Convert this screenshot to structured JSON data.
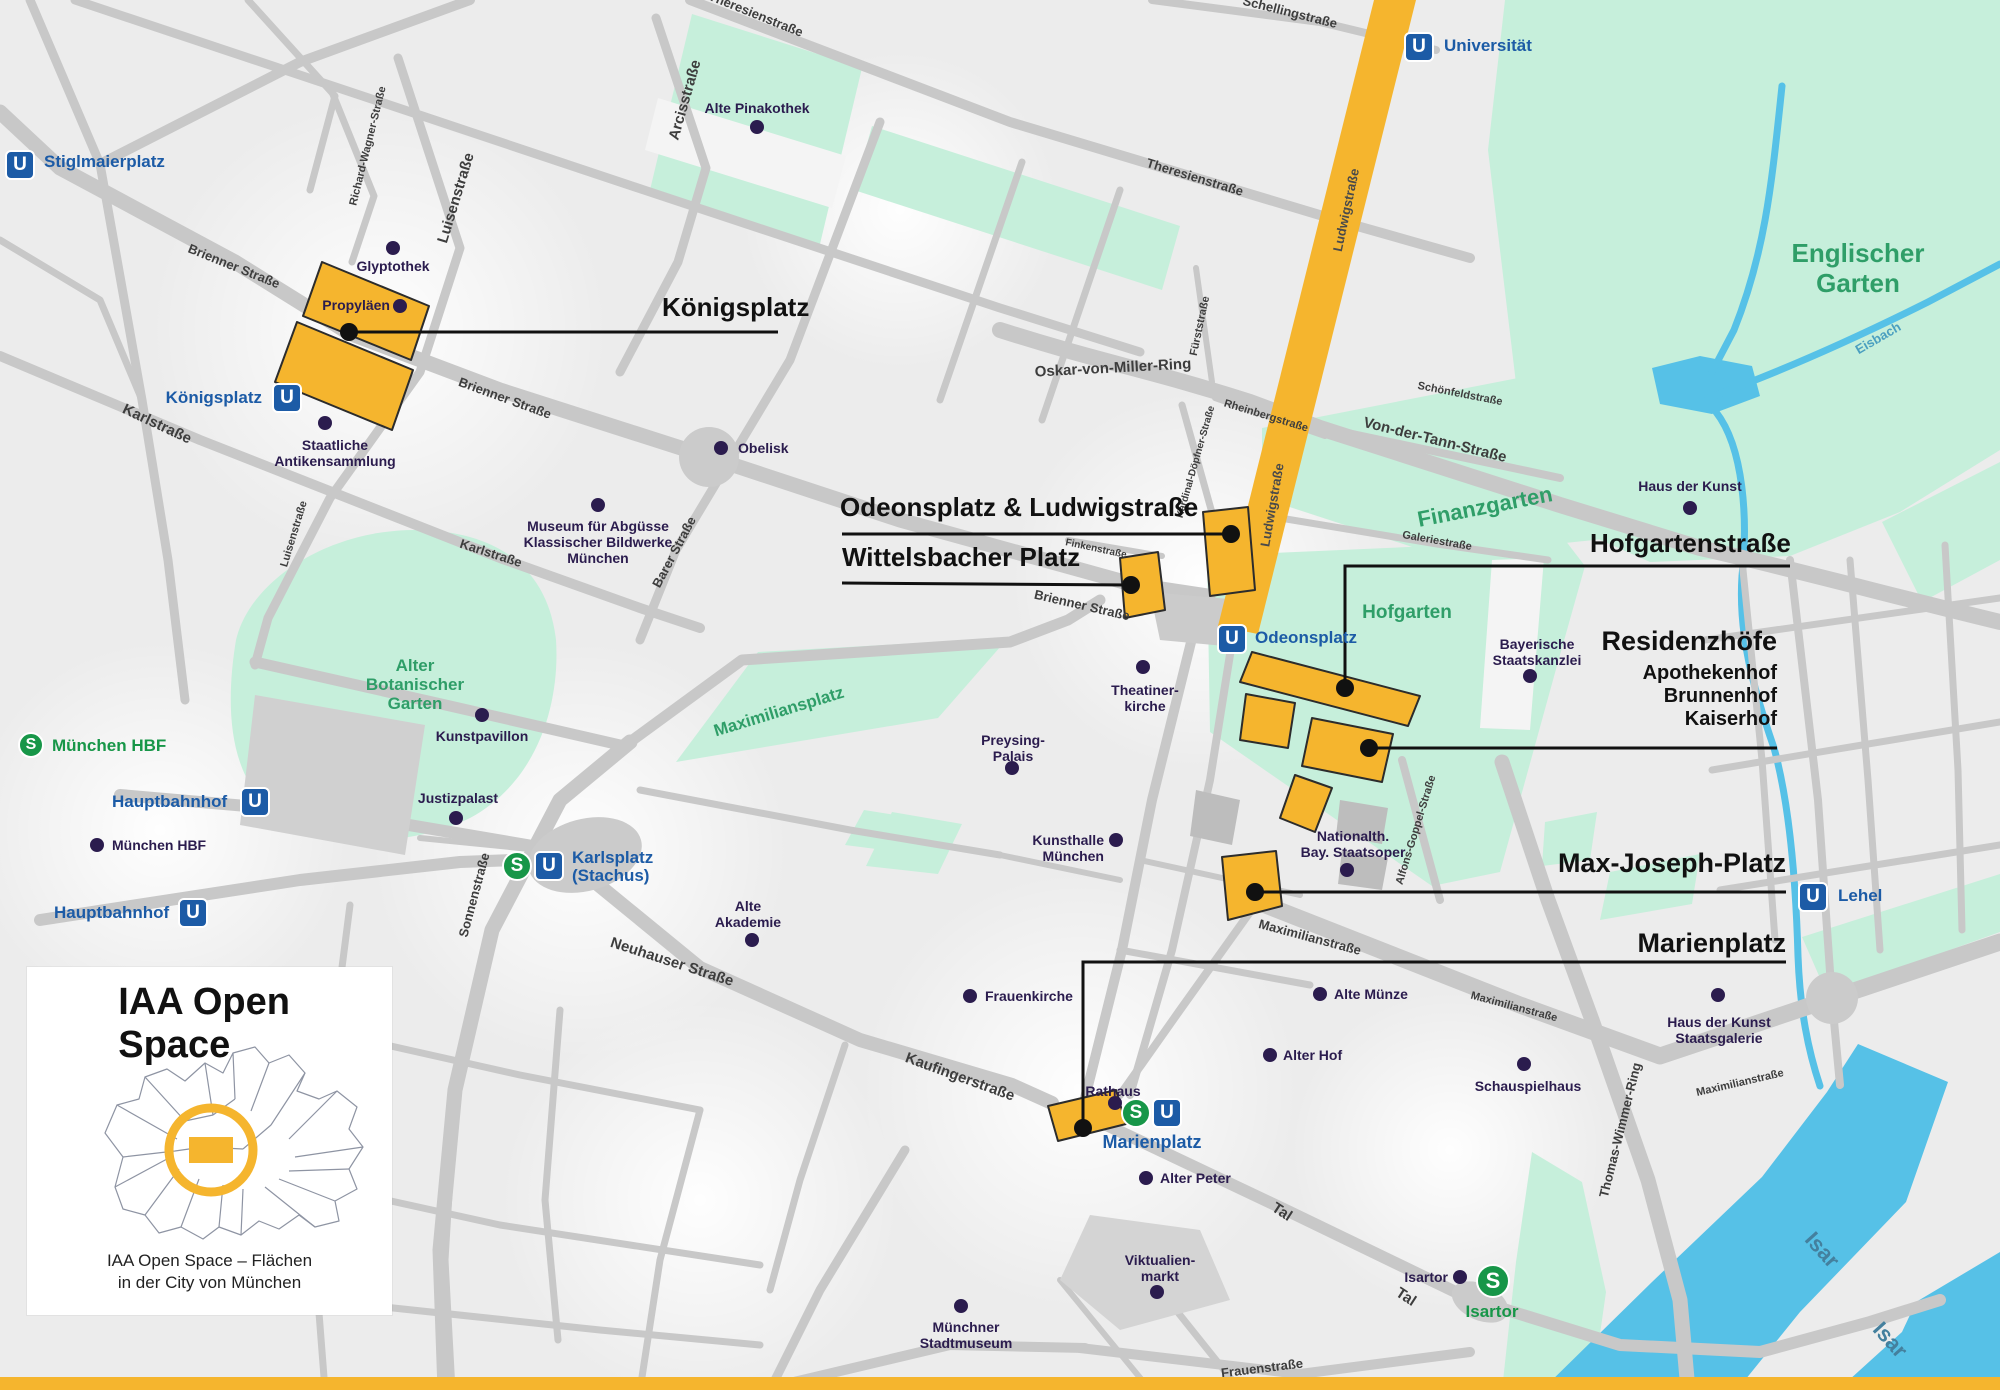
{
  "icons": {
    "u": "U",
    "s": "S"
  },
  "legend": {
    "title": "IAA Open Space",
    "caption1": "IAA Open Space – Flächen",
    "caption2": "in der City von München"
  },
  "callouts": {
    "koenigsplatz": "Königsplatz",
    "odeonsplatz_ludwigstrasse": "Odeonsplatz & Ludwigstraße",
    "wittelsbacher_platz": "Wittelsbacher Platz",
    "hofgartenstrasse": "Hofgartenstraße",
    "residenzhoefe": {
      "title": "Residenzhöfe",
      "sub1": "Apothekenhof",
      "sub2": "Brunnenhof",
      "sub3": "Kaiserhof"
    },
    "max_joseph_platz": "Max-Joseph-Platz",
    "marienplatz": "Marienplatz"
  },
  "stations": {
    "stiglmaierplatz": "Stiglmaierplatz",
    "universitaet": "Universität",
    "koenigsplatz": "Königsplatz",
    "odeonsplatz": "Odeonsplatz",
    "karlsplatz_line1": "Karlsplatz",
    "karlsplatz_line2": "(Stachus)",
    "hauptbahnhof_1": "Hauptbahnhof",
    "hauptbahnhof_2": "Hauptbahnhof",
    "muenchen_hbf_s": "München HBF",
    "marienplatz": "Marienplatz",
    "lehel": "Lehel",
    "isartor_s": "Isartor"
  },
  "pois": {
    "glyptothek": "Glyptothek",
    "propylaeen": "Propyläen",
    "antikensammlung_l1": "Staatliche",
    "antikensammlung_l2": "Antikensammlung",
    "museum_abguesse_l1": "Museum für Abgüsse",
    "museum_abguesse_l2": "Klassischer Bildwerke",
    "museum_abguesse_l3": "München",
    "alte_pinakothek": "Alte Pinakothek",
    "obelisk": "Obelisk",
    "kunstpavillon": "Kunstpavillon",
    "justizpalast": "Justizpalast",
    "muenchen_hbf": "München HBF",
    "alte_akademie_l1": "Alte",
    "alte_akademie_l2": "Akademie",
    "frauenkirche": "Frauenkirche",
    "theatinerkirche_l1": "Theatiner-",
    "theatinerkirche_l2": "kirche",
    "preysing_l1": "Preysing-",
    "preysing_l2": "Palais",
    "kunsthalle_l1": "Kunsthalle",
    "kunsthalle_l2": "München",
    "nationaltheater_l1": "Nationalth.",
    "nationaltheater_l2": "Bay. Staatsoper",
    "staatskanzlei_l1": "Bayerische",
    "staatskanzlei_l2": "Staatskanzlei",
    "haus_der_kunst": "Haus der Kunst",
    "alte_muenze": "Alte Münze",
    "alter_hof": "Alter Hof",
    "schauspielhaus": "Schauspielhaus",
    "hdk_staatsgalerie_l1": "Haus der Kunst",
    "hdk_staatsgalerie_l2": "Staatsgalerie",
    "rathaus": "Rathaus",
    "alter_peter": "Alter Peter",
    "viktualienmarkt_l1": "Viktualien-",
    "viktualienmarkt_l2": "markt",
    "stadtmuseum_l1": "Münchner",
    "stadtmuseum_l2": "Stadtmuseum",
    "isartor": "Isartor"
  },
  "streets": {
    "theresienstrasse_top": "Theresienstraße",
    "theresienstrasse": "Theresienstraße",
    "schellingstrasse": "Schellingstraße",
    "arcisstrasse": "Arcisstraße",
    "richard_wagner_strasse": "Richard-Wagner-Straße",
    "luisenstrasse_1": "Luisenstraße",
    "luisenstrasse_2": "Luisenstraße",
    "brienner_1": "Brienner Straße",
    "brienner_2": "Brienner Straße",
    "brienner_3": "Brienner Straße",
    "karlstrasse_1": "Karlstraße",
    "karlstrasse_2": "Karlstraße",
    "barer_strasse": "Barer Straße",
    "ludwigstrasse_1": "Ludwigstraße",
    "ludwigstrasse_2": "Ludwigstraße",
    "fuerststrasse": "Fürststraße",
    "rheinbergstrasse": "Rheinbergstraße",
    "oskar_von_miller_ring": "Oskar-von-Miller-Ring",
    "schoenfeldstrasse": "Schönfeldstraße",
    "von_der_tann_strasse": "Von-der-Tann-Straße",
    "galeriestrasse": "Galeriestraße",
    "finkenstrasse": "Finkenstraße",
    "kardinal_doepfner_strasse": "Kardinal-Döpfner-Straße",
    "alfons_goppel_strasse": "Alfons-Goppel-Straße",
    "maximilianstrasse_1": "Maximilianstraße",
    "maximilianstrasse_2": "Maximilianstraße",
    "maximilianstrasse_3": "Maximilianstraße",
    "neuhauser_strasse": "Neuhauser Straße",
    "kaufingerstrasse": "Kaufingerstraße",
    "sonnenstrasse": "Sonnenstraße",
    "thomas_wimmer_ring": "Thomas-Wimmer-Ring",
    "tal_1": "Tal",
    "tal_2": "Tal",
    "frauenstrasse": "Frauenstraße"
  },
  "parks": {
    "englischer_garten_l1": "Englischer",
    "englischer_garten_l2": "Garten",
    "finanzgarten": "Finanzgarten",
    "hofgarten": "Hofgarten",
    "alter_bot_garten_l1": "Alter",
    "alter_bot_garten_l2": "Botanischer",
    "alter_bot_garten_l3": "Garten",
    "maximiliansplatz": "Maximiliansplatz"
  },
  "water": {
    "isar_1": "Isar",
    "isar_2": "Isar",
    "eisbach": "Eisbach"
  },
  "colors": {
    "highlight_yellow": "#F5B52E",
    "park_green": "#c6efdb",
    "water_blue": "#56c1e7",
    "street_gray": "#c8c8c8",
    "poi_navy": "#2b1c4e",
    "ubahn_blue": "#1c5ba6",
    "sbahn_green": "#179648"
  }
}
